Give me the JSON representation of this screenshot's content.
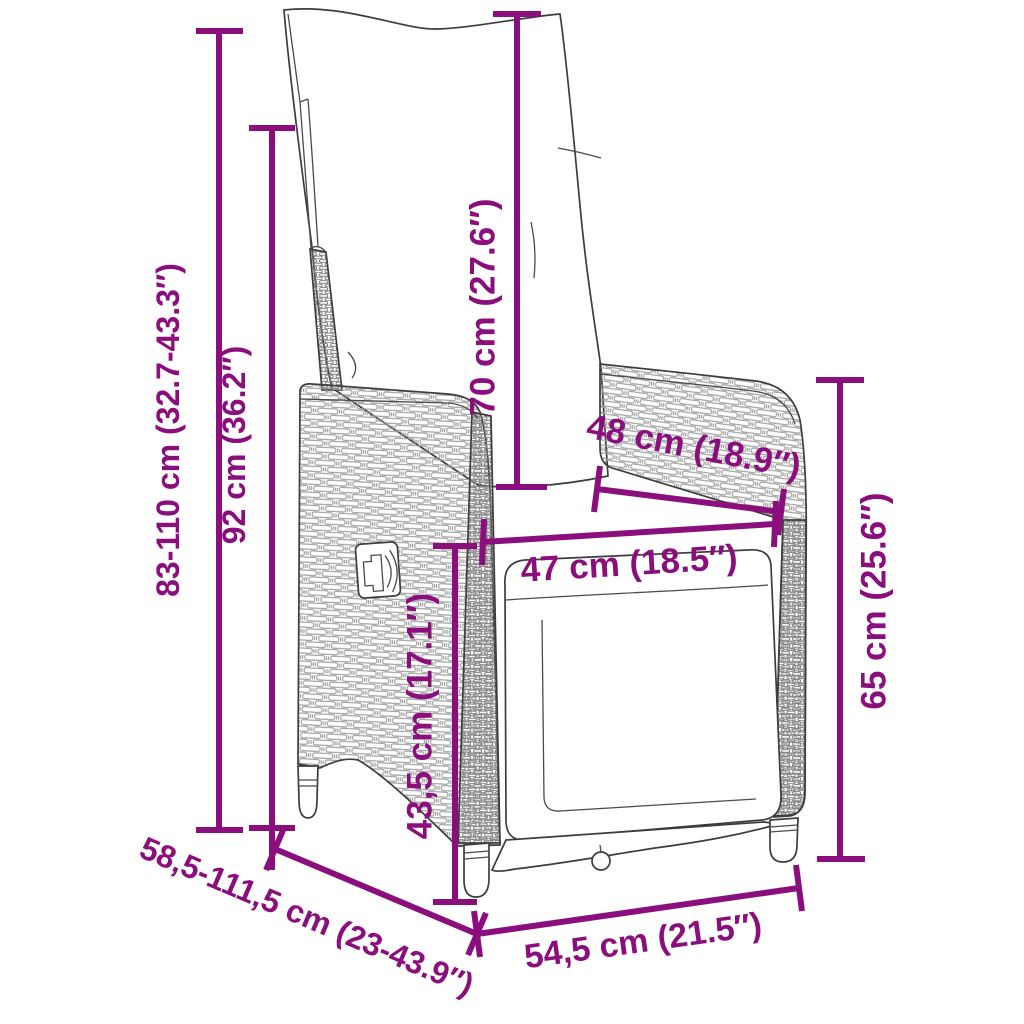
{
  "page": {
    "background_color": "#ffffff"
  },
  "diagram": {
    "subject": "Reclining garden chair with cushions - dimension drawing",
    "accent_color": "#8B0E7D",
    "outline_color": "#3d3d3d",
    "wicker_line_color": "#9a9a9a",
    "icons": {
      "knob": "recline-adjustment-knob-icon"
    },
    "dimensions": [
      {
        "id": "total-height-range",
        "label": "83-110 cm (32.7-43.3″)",
        "orientation": "vertical"
      },
      {
        "id": "backrest-height",
        "label": "92 cm (36.2″)",
        "orientation": "vertical"
      },
      {
        "id": "back-cushion-height",
        "label": "70 cm (27.6″)",
        "orientation": "vertical"
      },
      {
        "id": "backrest-width",
        "label": "48 cm (18.9″)",
        "orientation": "diagonal"
      },
      {
        "id": "seat-width",
        "label": "47 cm (18.5″)",
        "orientation": "horizontal"
      },
      {
        "id": "armrest-height",
        "label": "65 cm (25.6″)",
        "orientation": "vertical"
      },
      {
        "id": "seat-height",
        "label": "43,5 cm (17.1″)",
        "orientation": "vertical"
      },
      {
        "id": "depth-range",
        "label": "58,5-111,5 cm (23-43.9″)",
        "orientation": "diagonal"
      },
      {
        "id": "seat-depth",
        "label": "54,5 cm (21.5″)",
        "orientation": "horizontal"
      }
    ]
  }
}
